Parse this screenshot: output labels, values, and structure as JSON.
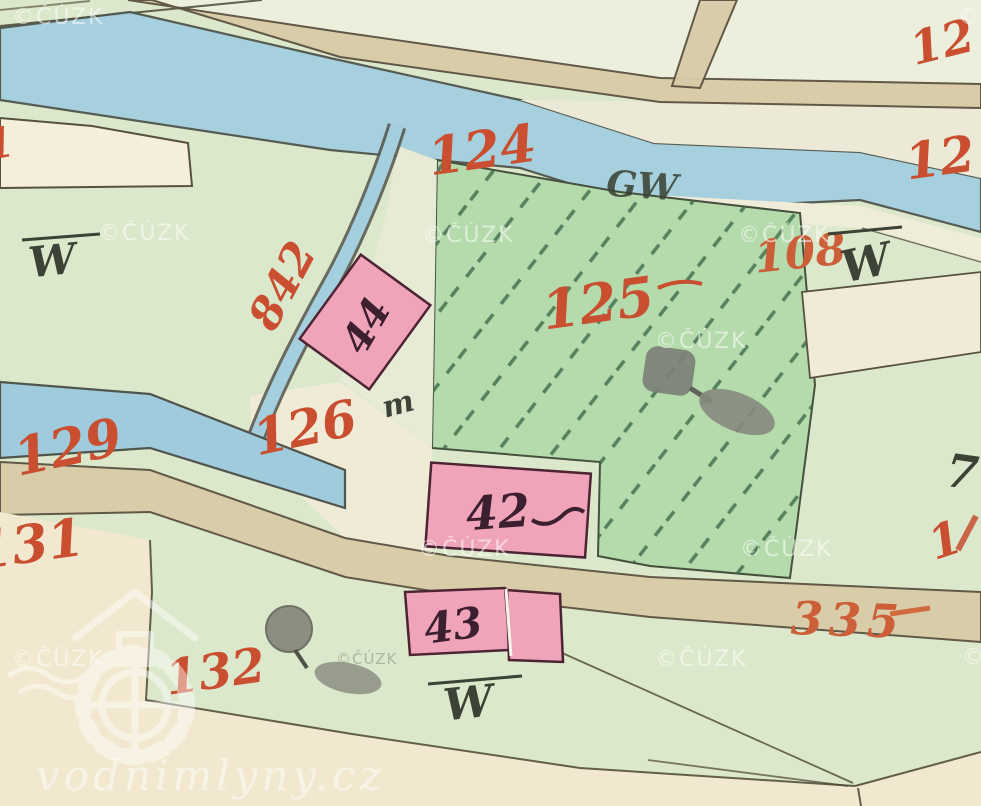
{
  "map": {
    "title": "historical cadastral map scan",
    "labels": {
      "parcel_124": "124",
      "parcel_125": "125",
      "parcel_126": "126",
      "parcel_129": "129",
      "parcel_131": "131",
      "parcel_132": "132",
      "parcel_108": "108",
      "parcel_335": "335",
      "parcel_842": "842",
      "parcel_12_top": "12",
      "parcel_12_mid": "12",
      "edge_7": "7",
      "edge_1_right": "1",
      "edge_1_left": "1",
      "building_42": "42",
      "building_43": "43",
      "building_44": "44",
      "letter_gw": "GW",
      "letter_w_left": "W",
      "letter_w_right": "W",
      "letter_w_bottom": "W",
      "letter_m": "m"
    },
    "watermarks": {
      "cuzk": "©ČÚZK",
      "cuzk_partial": "©Č",
      "site": "vodnimlyny.cz"
    },
    "colors": {
      "field_green": "#dce8cb",
      "orchard_green": "#b5dbac",
      "hatch_line": "#3e6b4a",
      "water_blue": "#a4cfdf",
      "road_tan": "#d8cba8",
      "parcel_cream": "#f4eedb",
      "building_pink": "#f0a4ba",
      "label_red": "#c94f30",
      "label_orange": "#cf6b3d",
      "ink": "#4b4734"
    }
  }
}
